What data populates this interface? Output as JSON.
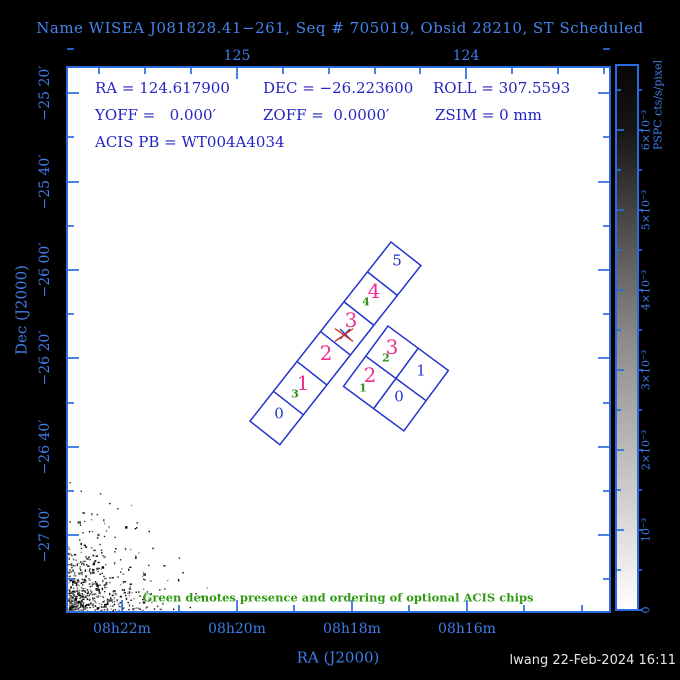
{
  "title": "Name WISEA J081828.41−261, Seq # 705019, Obsid 28210, ST Scheduled",
  "footer": "lwang 22-Feb-2024 16:11",
  "note": "Green denotes presence and ordering of optional ACIS chips",
  "info_lines": [
    {
      "y": 81,
      "items": [
        {
          "t": "RA = 124.617900",
          "x": 95
        },
        {
          "t": "DEC = −26.223600",
          "x": 263
        },
        {
          "t": "ROLL = 307.5593",
          "x": 433
        }
      ]
    },
    {
      "y": 108,
      "items": [
        {
          "t": "YOFF =   0.000′",
          "x": 95
        },
        {
          "t": "ZOFF =  0.0000′",
          "x": 263
        },
        {
          "t": "ZSIM = 0 mm",
          "x": 435
        }
      ]
    },
    {
      "y": 135,
      "items": [
        {
          "t": "ACIS PB = WT004A4034",
          "x": 95
        }
      ]
    }
  ],
  "colors": {
    "frame_blue": "#2a6ce0",
    "label_blue": "#3f7de8",
    "text_blue": "#2424c0",
    "chip_blue": "#2233cc",
    "magenta": "#ee2f8e",
    "green": "#2f8f1a",
    "red": "#d03028",
    "plot_bg": "#ffffff",
    "bg": "#000000"
  },
  "chart_data": {
    "type": "scatter",
    "subtype": "observation-fov-overlay-on-sky-image",
    "title": "ACIS field-of-view over PSPC image",
    "xlabel": "RA (J2000)",
    "ylabel": "Dec (J2000)",
    "x_range_ra_deg": [
      125.74,
      123.38
    ],
    "y_range_dec_deg": [
      -25.23,
      -27.29
    ],
    "grid": false,
    "frame": {
      "left": 67,
      "top": 67,
      "right": 610,
      "bottom": 612
    },
    "axes": {
      "x_bottom": {
        "label": "RA (J2000)",
        "major": [
          {
            "px": 122,
            "label": "08h22m"
          },
          {
            "px": 237,
            "label": "08h20m"
          },
          {
            "px": 352,
            "label": "08h18m"
          },
          {
            "px": 467,
            "label": "08h16m"
          }
        ],
        "minor": [
          179,
          294,
          409,
          524,
          582
        ],
        "tick_label_y": 629,
        "axis_label_pos": {
          "x": 338,
          "y": 658
        }
      },
      "x_top": {
        "major": [
          {
            "px": 237,
            "label": "125"
          },
          {
            "px": 466,
            "label": "124"
          }
        ],
        "minor": [
          99,
          145,
          191,
          283,
          329,
          375,
          420,
          512,
          558,
          604
        ],
        "tick_label_y": 56
      },
      "y_left": {
        "label": "Dec (J2000)",
        "major": [
          {
            "px": 93,
            "label": "−25 20′"
          },
          {
            "px": 182,
            "label": "−25 40′"
          },
          {
            "px": 270,
            "label": "−26 00′"
          },
          {
            "px": 358,
            "label": "−26 20′"
          },
          {
            "px": 447,
            "label": "−26 40′"
          },
          {
            "px": 535,
            "label": "−27 00′"
          }
        ],
        "minor": [
          49,
          137,
          226,
          314,
          403,
          491,
          579
        ],
        "tick_label_x": 45,
        "axis_label_pos": {
          "x": 22,
          "y": 310
        }
      }
    },
    "colorbar": {
      "unit_label": "PSPC cts/s/pixel",
      "x0": 616,
      "x1": 638,
      "top": 65,
      "bottom": 610,
      "major": [
        {
          "px": 130,
          "label": "6×10⁻³"
        },
        {
          "px": 210,
          "label": "5×10⁻³"
        },
        {
          "px": 290,
          "label": "4×10⁻³"
        },
        {
          "px": 370,
          "label": "3×10⁻³"
        },
        {
          "px": 450,
          "label": "2×10⁻³"
        },
        {
          "px": 530,
          "label": "10⁻³"
        },
        {
          "px": 610,
          "label": "0"
        }
      ],
      "minor": [
        90,
        170,
        250,
        330,
        410,
        490,
        570
      ],
      "value_label_x": 646,
      "unit_label_pos": {
        "x": 658,
        "y": 105
      },
      "scale_top_black_bottom_white": true
    },
    "chips": {
      "acis_s_strip": {
        "origin": [
          391,
          242
        ],
        "angle_deg": 128.2,
        "chip_size": 38,
        "count": 6,
        "labels": [
          {
            "text": "5",
            "cls": "b",
            "x": 397,
            "y": 261
          },
          {
            "text": "4",
            "cls": "m",
            "x": 374,
            "y": 291
          },
          {
            "text": "4",
            "cls": "g",
            "x": 366,
            "y": 302
          },
          {
            "text": "3",
            "cls": "m",
            "x": 351,
            "y": 320
          },
          {
            "text": "2",
            "cls": "m",
            "x": 326,
            "y": 353
          },
          {
            "text": "1",
            "cls": "m",
            "x": 303,
            "y": 383
          },
          {
            "text": "3",
            "cls": "g",
            "x": 295,
            "y": 394
          },
          {
            "text": "0",
            "cls": "b",
            "x": 279,
            "y": 414
          }
        ]
      },
      "acis_i_block": {
        "origin": [
          388,
          326
        ],
        "angle_deg": 36.4,
        "chip_size": 37.5,
        "grid": [
          2,
          2
        ],
        "labels": [
          {
            "text": "3",
            "cls": "m",
            "x": 392,
            "y": 347
          },
          {
            "text": "2",
            "cls": "g",
            "x": 386,
            "y": 358
          },
          {
            "text": "1",
            "cls": "b",
            "x": 421,
            "y": 371
          },
          {
            "text": "2",
            "cls": "m",
            "x": 370,
            "y": 375
          },
          {
            "text": "1",
            "cls": "g",
            "x": 363,
            "y": 388
          },
          {
            "text": "0",
            "cls": "b",
            "x": 399,
            "y": 397
          }
        ]
      }
    },
    "markers": {
      "target_cross_blue": {
        "x": 345,
        "y": 334,
        "arm": 5
      },
      "aimpoint_cross_red": {
        "x": 344,
        "y": 335,
        "arm": 9
      }
    },
    "noise_region": {
      "corner_x": 68,
      "corner_y": 610,
      "fall_x": 26,
      "fall_y": 24,
      "count": 560,
      "max_dx": 148,
      "max_dy": 138
    }
  }
}
